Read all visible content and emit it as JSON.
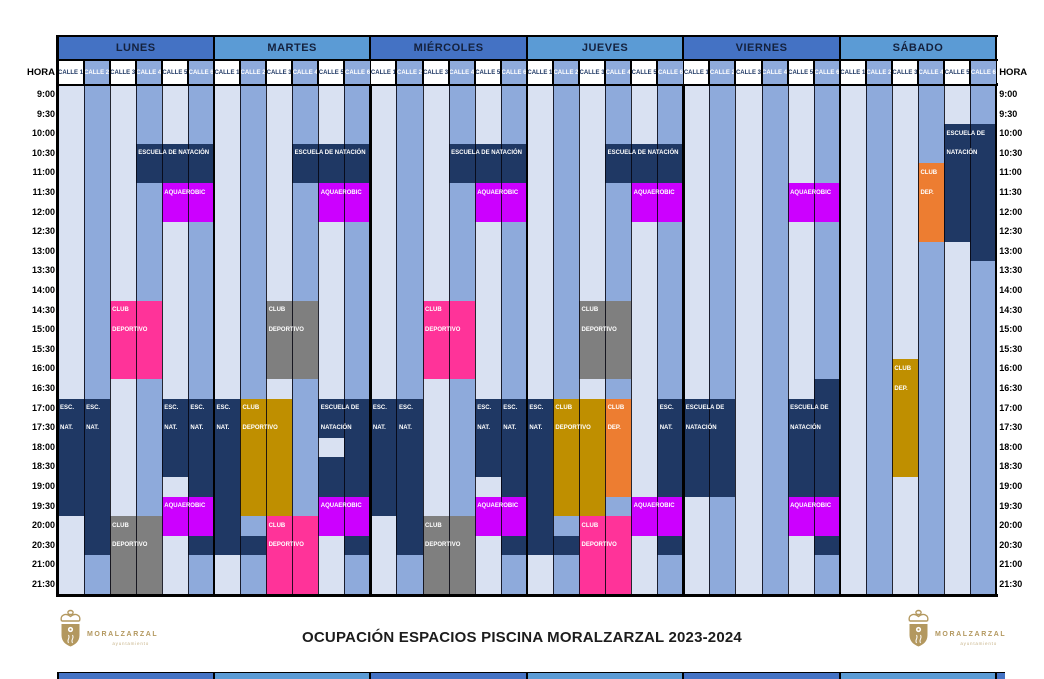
{
  "title": "OCUPACIÓN ESPACIOS PISCINA MORALZARZAL 2023-2024",
  "hora_label": "HORA",
  "days": [
    "LUNES",
    "MARTES",
    "MIÉRCOLES",
    "JUEVES",
    "VIERNES",
    "SÁBADO"
  ],
  "lane_labels": [
    "CALLE 1",
    "CALLE 2",
    "CALLE 3",
    "CALLE 4",
    "CALLE 5",
    "CALLE 6"
  ],
  "times": [
    "9:00",
    "9:30",
    "10:00",
    "10:30",
    "11:00",
    "11:30",
    "12:00",
    "12:30",
    "13:00",
    "13:30",
    "14:00",
    "14:30",
    "15:00",
    "15:30",
    "16:00",
    "16:30",
    "17:00",
    "17:30",
    "18:00",
    "18:30",
    "19:00",
    "19:30",
    "20:00",
    "20:30",
    "21:00",
    "21:30"
  ],
  "colors": {
    "day_header_dark": "#4472C4",
    "day_header_light": "#5B9BD5",
    "lane_light": "#D9E1F2",
    "lane_medium": "#8EAADB",
    "lane_head_text": "#1F3864",
    "navy": "#1F3864",
    "magenta": "#CC00FF",
    "pink": "#FF3399",
    "gray": "#7F7F7F",
    "gold": "#BF8F00",
    "orange": "#ED7D31",
    "logo_gold": "#B3985F"
  },
  "events": [
    {
      "day": 0,
      "lanes": [
        4,
        6
      ],
      "start": "10:30",
      "slots": 2,
      "color": "navy",
      "labels": [
        "ESCUELA DE NATACIÓN"
      ]
    },
    {
      "day": 0,
      "lanes": [
        5,
        6
      ],
      "start": "11:30",
      "slots": 2,
      "color": "magenta",
      "labels": [
        "AQUAEROBIC"
      ]
    },
    {
      "day": 0,
      "lanes": [
        3,
        4
      ],
      "start": "14:30",
      "slots": 4,
      "color": "pink",
      "labels": [
        "CLUB",
        "DEPORTIVO"
      ]
    },
    {
      "day": 0,
      "lanes": [
        1,
        1
      ],
      "start": "17:00",
      "slots": 6,
      "color": "navy",
      "labels": [
        "ESC.",
        "NAT."
      ]
    },
    {
      "day": 0,
      "lanes": [
        2,
        2
      ],
      "start": "17:00",
      "slots": 8,
      "color": "navy",
      "labels": [
        "ESC.",
        "NAT."
      ]
    },
    {
      "day": 0,
      "lanes": [
        5,
        5
      ],
      "start": "17:00",
      "slots": 4,
      "color": "navy",
      "labels": [
        "ESC.",
        "NAT."
      ]
    },
    {
      "day": 0,
      "lanes": [
        6,
        6
      ],
      "start": "17:00",
      "slots": 5,
      "color": "navy",
      "labels": [
        "ESC.",
        "NAT."
      ]
    },
    {
      "day": 0,
      "lanes": [
        5,
        6
      ],
      "start": "19:30",
      "slots": 2,
      "color": "magenta",
      "labels": [
        "AQUAEROBIC"
      ]
    },
    {
      "day": 0,
      "lanes": [
        3,
        4
      ],
      "start": "20:00",
      "slots": 4,
      "color": "gray",
      "labels": [
        "CLUB",
        "DEPORTIVO"
      ]
    },
    {
      "day": 0,
      "lanes": [
        6,
        6
      ],
      "start": "20:30",
      "slots": 1,
      "color": "navy",
      "labels": []
    },
    {
      "day": 1,
      "lanes": [
        4,
        6
      ],
      "start": "10:30",
      "slots": 2,
      "color": "navy",
      "labels": [
        "ESCUELA DE NATACIÓN"
      ]
    },
    {
      "day": 1,
      "lanes": [
        5,
        6
      ],
      "start": "11:30",
      "slots": 2,
      "color": "magenta",
      "labels": [
        "AQUAEROBIC"
      ]
    },
    {
      "day": 1,
      "lanes": [
        3,
        4
      ],
      "start": "14:30",
      "slots": 4,
      "color": "gray",
      "labels": [
        "CLUB",
        "DEPORTIVO"
      ]
    },
    {
      "day": 1,
      "lanes": [
        1,
        1
      ],
      "start": "17:00",
      "slots": 8,
      "color": "navy",
      "labels": [
        "ESC.",
        "NAT."
      ]
    },
    {
      "day": 1,
      "lanes": [
        2,
        3
      ],
      "start": "17:00",
      "slots": 6,
      "color": "gold",
      "labels": [
        "CLUB",
        "DEPORTIVO"
      ]
    },
    {
      "day": 1,
      "lanes": [
        5,
        5
      ],
      "start": "17:00",
      "slots": 2,
      "color": "navy",
      "labels": [
        "ESCUELA DE",
        "NATACIÓN"
      ]
    },
    {
      "day": 1,
      "lanes": [
        6,
        6
      ],
      "start": "17:00",
      "slots": 5,
      "color": "navy",
      "labels": []
    },
    {
      "day": 1,
      "lanes": [
        5,
        5
      ],
      "start": "18:30",
      "slots": 2,
      "color": "navy",
      "labels": []
    },
    {
      "day": 1,
      "lanes": [
        5,
        6
      ],
      "start": "19:30",
      "slots": 2,
      "color": "magenta",
      "labels": [
        "AQUAEROBIC"
      ]
    },
    {
      "day": 1,
      "lanes": [
        3,
        4
      ],
      "start": "20:00",
      "slots": 4,
      "color": "pink",
      "labels": [
        "CLUB",
        "DEPORTIVO"
      ]
    },
    {
      "day": 1,
      "lanes": [
        2,
        2
      ],
      "start": "20:30",
      "slots": 1,
      "color": "navy",
      "labels": []
    },
    {
      "day": 1,
      "lanes": [
        6,
        6
      ],
      "start": "20:30",
      "slots": 1,
      "color": "navy",
      "labels": []
    },
    {
      "day": 2,
      "lanes": [
        4,
        6
      ],
      "start": "10:30",
      "slots": 2,
      "color": "navy",
      "labels": [
        "ESCUELA DE NATACIÓN"
      ]
    },
    {
      "day": 2,
      "lanes": [
        5,
        6
      ],
      "start": "11:30",
      "slots": 2,
      "color": "magenta",
      "labels": [
        "AQUAEROBIC"
      ]
    },
    {
      "day": 2,
      "lanes": [
        3,
        4
      ],
      "start": "14:30",
      "slots": 4,
      "color": "pink",
      "labels": [
        "CLUB",
        "DEPORTIVO"
      ]
    },
    {
      "day": 2,
      "lanes": [
        1,
        1
      ],
      "start": "17:00",
      "slots": 6,
      "color": "navy",
      "labels": [
        "ESC.",
        "NAT."
      ]
    },
    {
      "day": 2,
      "lanes": [
        2,
        2
      ],
      "start": "17:00",
      "slots": 8,
      "color": "navy",
      "labels": [
        "ESC.",
        "NAT."
      ]
    },
    {
      "day": 2,
      "lanes": [
        5,
        5
      ],
      "start": "17:00",
      "slots": 4,
      "color": "navy",
      "labels": [
        "ESC.",
        "NAT."
      ]
    },
    {
      "day": 2,
      "lanes": [
        6,
        6
      ],
      "start": "17:00",
      "slots": 5,
      "color": "navy",
      "labels": [
        "ESC.",
        "NAT."
      ]
    },
    {
      "day": 2,
      "lanes": [
        5,
        6
      ],
      "start": "19:30",
      "slots": 2,
      "color": "magenta",
      "labels": [
        "AQUAEROBIC"
      ]
    },
    {
      "day": 2,
      "lanes": [
        3,
        4
      ],
      "start": "20:00",
      "slots": 4,
      "color": "gray",
      "labels": [
        "CLUB",
        "DEPORTIVO"
      ]
    },
    {
      "day": 2,
      "lanes": [
        6,
        6
      ],
      "start": "20:30",
      "slots": 1,
      "color": "navy",
      "labels": []
    },
    {
      "day": 3,
      "lanes": [
        4,
        6
      ],
      "start": "10:30",
      "slots": 2,
      "color": "navy",
      "labels": [
        "ESCUELA DE NATACIÓN"
      ]
    },
    {
      "day": 3,
      "lanes": [
        5,
        6
      ],
      "start": "11:30",
      "slots": 2,
      "color": "magenta",
      "labels": [
        "AQUAEROBIC"
      ]
    },
    {
      "day": 3,
      "lanes": [
        3,
        4
      ],
      "start": "14:30",
      "slots": 4,
      "color": "gray",
      "labels": [
        "CLUB",
        "DEPORTIVO"
      ]
    },
    {
      "day": 3,
      "lanes": [
        1,
        1
      ],
      "start": "17:00",
      "slots": 8,
      "color": "navy",
      "labels": [
        "ESC.",
        "NAT."
      ]
    },
    {
      "day": 3,
      "lanes": [
        2,
        3
      ],
      "start": "17:00",
      "slots": 6,
      "color": "gold",
      "labels": [
        "CLUB",
        "DEPORTIVO"
      ]
    },
    {
      "day": 3,
      "lanes": [
        4,
        4
      ],
      "start": "17:00",
      "slots": 5,
      "color": "orange",
      "labels": [
        "CLUB",
        "DEP."
      ]
    },
    {
      "day": 3,
      "lanes": [
        6,
        6
      ],
      "start": "17:00",
      "slots": 5,
      "color": "navy",
      "labels": [
        "ESC.",
        "NAT."
      ]
    },
    {
      "day": 3,
      "lanes": [
        5,
        6
      ],
      "start": "19:30",
      "slots": 2,
      "color": "magenta",
      "labels": [
        "AQUAEROBIC"
      ]
    },
    {
      "day": 3,
      "lanes": [
        3,
        4
      ],
      "start": "20:00",
      "slots": 4,
      "color": "pink",
      "labels": [
        "CLUB",
        "DEPORTIVO"
      ]
    },
    {
      "day": 3,
      "lanes": [
        2,
        2
      ],
      "start": "20:30",
      "slots": 1,
      "color": "navy",
      "labels": []
    },
    {
      "day": 3,
      "lanes": [
        6,
        6
      ],
      "start": "20:30",
      "slots": 1,
      "color": "navy",
      "labels": []
    },
    {
      "day": 4,
      "lanes": [
        5,
        6
      ],
      "start": "11:30",
      "slots": 2,
      "color": "magenta",
      "labels": [
        "AQUAEROBIC"
      ]
    },
    {
      "day": 4,
      "lanes": [
        1,
        2
      ],
      "start": "17:00",
      "slots": 5,
      "color": "navy",
      "labels": [
        "ESCUELA DE",
        "NATACIÓN"
      ]
    },
    {
      "day": 4,
      "lanes": [
        6,
        6
      ],
      "start": "16:30",
      "slots": 6,
      "color": "navy",
      "labels": []
    },
    {
      "day": 4,
      "lanes": [
        5,
        5
      ],
      "start": "17:00",
      "slots": 5,
      "color": "navy",
      "labels": [
        "ESCUELA DE",
        "NATACIÓN"
      ]
    },
    {
      "day": 4,
      "lanes": [
        5,
        6
      ],
      "start": "19:30",
      "slots": 2,
      "color": "magenta",
      "labels": [
        "AQUAEROBIC"
      ]
    },
    {
      "day": 4,
      "lanes": [
        6,
        6
      ],
      "start": "20:30",
      "slots": 1,
      "color": "navy",
      "labels": []
    },
    {
      "day": 5,
      "lanes": [
        5,
        5
      ],
      "start": "10:00",
      "slots": 6,
      "color": "navy",
      "labels": [
        "ESCUELA DE",
        "NATACIÓN"
      ]
    },
    {
      "day": 5,
      "lanes": [
        6,
        6
      ],
      "start": "10:00",
      "slots": 7,
      "color": "navy",
      "labels": []
    },
    {
      "day": 5,
      "lanes": [
        4,
        4
      ],
      "start": "11:00",
      "slots": 4,
      "color": "orange",
      "labels": [
        "CLUB",
        "DEP."
      ]
    },
    {
      "day": 5,
      "lanes": [
        3,
        3
      ],
      "start": "16:00",
      "slots": 6,
      "color": "gold",
      "labels": [
        "CLUB",
        "DEP."
      ]
    }
  ],
  "logo": {
    "name": "MORALZARZAL",
    "sub": "ayuntamiento"
  }
}
